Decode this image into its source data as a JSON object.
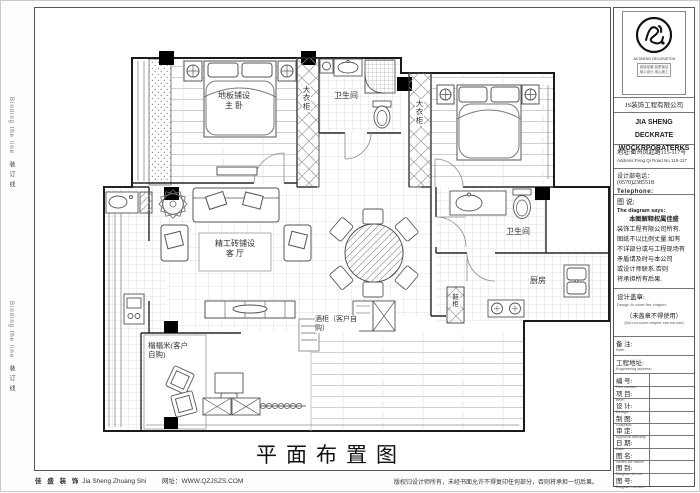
{
  "sheet": {
    "title": "平面布置图"
  },
  "binding": {
    "en": "Binding the line",
    "cn": "装订线"
  },
  "footer": {
    "brand_cn": "佳 盛 装 饰",
    "brand_py": "Jia Sheng Zhuang Shi",
    "website": "网址：WWW.QZJSZS.COM",
    "copyright": "版权归设计师所有，未经书面允许不得复印任何部分，否则将承担一切后果。"
  },
  "titleblock": {
    "logo_caption": "JIA SHENG DECORATION",
    "tagline1": "诚信经营 品质保证",
    "tagline2": "用心设计 用心施工",
    "company_cn": "JS装饰工程有限公司",
    "company_en1": "JIA SHENG DECKRATE",
    "company_en2": "WOCKRPORATERKS",
    "address_cn": "地址:衢州凤起路115-117号",
    "address_en": "Address:Feng Qi Road No.115-117",
    "phone_cn": "设计部电话： (0570)2385518",
    "phone_en": "Telephone:",
    "notes": {
      "title_cn": "图 说:",
      "title_en": "The diagram says:",
      "lines": [
        "本图解释权属佳盛",
        "装饰工程有限公司所有.",
        "图纸不以比例丈量.如有",
        "不详部分或与工程现场有",
        "矛盾请及时与本公司",
        "或设计师联系.否则",
        "将承担所有后果."
      ]
    },
    "seal": {
      "title_cn": "设计盖章:",
      "title_en": "Design to cover the chapter:",
      "warn_cn": "（未盖章不得使用）",
      "warn_en": "(Did not cover chapter can not use)"
    },
    "fields": [
      {
        "cn": "备 注:",
        "en": "Note:"
      },
      {
        "cn": "工程地址:",
        "en": "Engineering address:"
      },
      {
        "cn": "编 号:",
        "en": "Plot number:"
      },
      {
        "cn": "项 目:",
        "en": "Item:"
      },
      {
        "cn": "设 计:",
        "en": "Design:"
      },
      {
        "cn": "制 图:",
        "en": "Graphics:"
      },
      {
        "cn": "审 定:",
        "en": "Approval officially:"
      },
      {
        "cn": "日 期:",
        "en": "Date:"
      },
      {
        "cn": "图 名:",
        "en": "Series for Name:"
      },
      {
        "cn": "图 别:",
        "en": "Diagram do not:"
      },
      {
        "cn": "图 号:",
        "en": "Diagram number:"
      }
    ]
  },
  "plan": {
    "master_line1": "地板铺设",
    "master_line2": "主 卧",
    "wardrobe1": "大衣柜",
    "wardrobe2": "大衣柜",
    "bath_top": "卫生间",
    "bath_right": "卫生间",
    "kitchen": "厨房",
    "living_line1": "精工砖铺设",
    "living_line2": "客 厅",
    "wine_cabinet": "酒柜（客户自购）",
    "tatami": "榻榻米(客户自购)",
    "shoe_cabinet": "鞋柜"
  }
}
